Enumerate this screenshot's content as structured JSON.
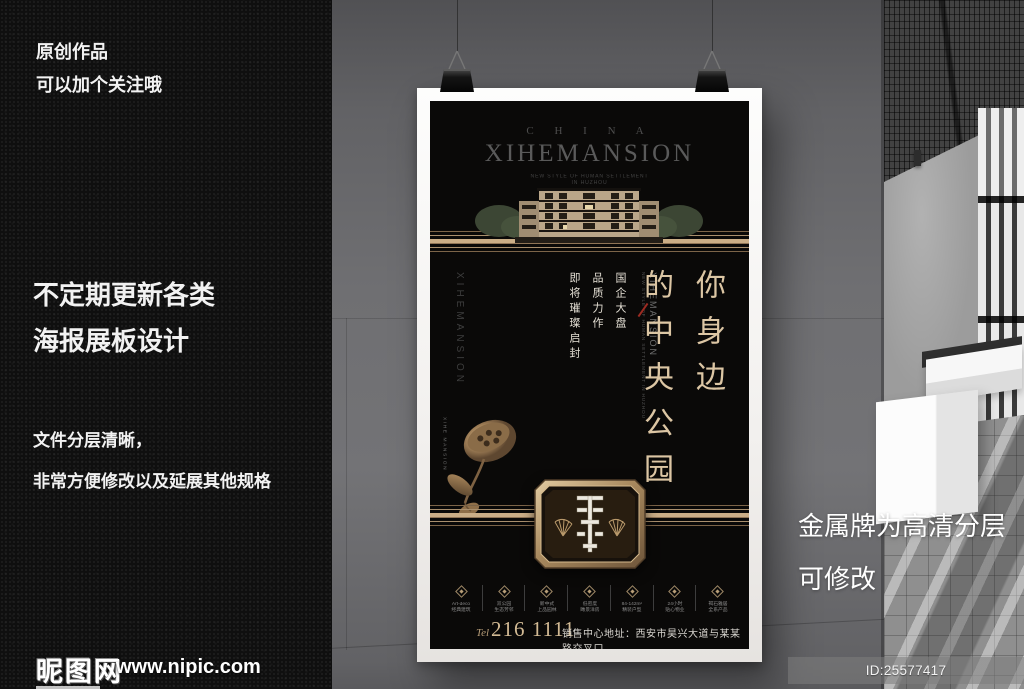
{
  "left_wall": {
    "note_top": [
      "原创作品",
      "可以加个关注哦"
    ],
    "note_mid": [
      "不定期更新各类",
      "海报展板设计"
    ],
    "note_bottom": [
      "文件分层清晰，",
      "非常方便修改以及延展其他规格"
    ]
  },
  "right_note": {
    "line1": "金属牌为高清分层",
    "line2": "可修改"
  },
  "watermark": {
    "site_name": "昵图网",
    "site_url": "www.nipic.com",
    "id_text": "ID:25577417 NO:20170911215906179031"
  },
  "poster": {
    "brand_top": "C H I N A",
    "brand_name": "XIHEMANSION",
    "brand_sub1": "NEW STYLE OF HUMAN SETTLEMENT",
    "brand_sub2": "IN HUZHOU",
    "side_vertical_text": "XIHEMANSION",
    "slogans": [
      "国企大盘",
      "品质力作",
      "即将璀璨启封"
    ],
    "center_vertical_text": "XIHEMANSION",
    "center_vertical_sub": "NEW STYLE OF HUMAN SETTLEMENT IN HUZHOU",
    "headline_col1": "你身边",
    "headline_col2": "的中央公园",
    "lotus_label": "XIHE MANSION",
    "features": [
      {
        "line1": "Art-deco",
        "line2": "经典建筑"
      },
      {
        "line1": "双公园",
        "line2": "生态芳邻"
      },
      {
        "line1": "新中式",
        "line2": "上品园林"
      },
      {
        "line1": "低密度",
        "line2": "瞰景洋房"
      },
      {
        "line1": "84-142m²",
        "line2": "精装户型"
      },
      {
        "line1": "24小时",
        "line2": "贴心物业"
      },
      {
        "line1": "褐石雅居",
        "line2": "全系产品"
      }
    ],
    "tel_label": "Tel",
    "tel_number": "216 1111",
    "address": "销售中心地址：西安市昊兴大道与某某路交叉口"
  },
  "colors": {
    "poster_black": "#0a0908",
    "gold_accent": "#cbae87",
    "headline_gold": "#dcc6a4",
    "red_slash": "#9c2b22",
    "gray_wall": "#6f6f72"
  }
}
